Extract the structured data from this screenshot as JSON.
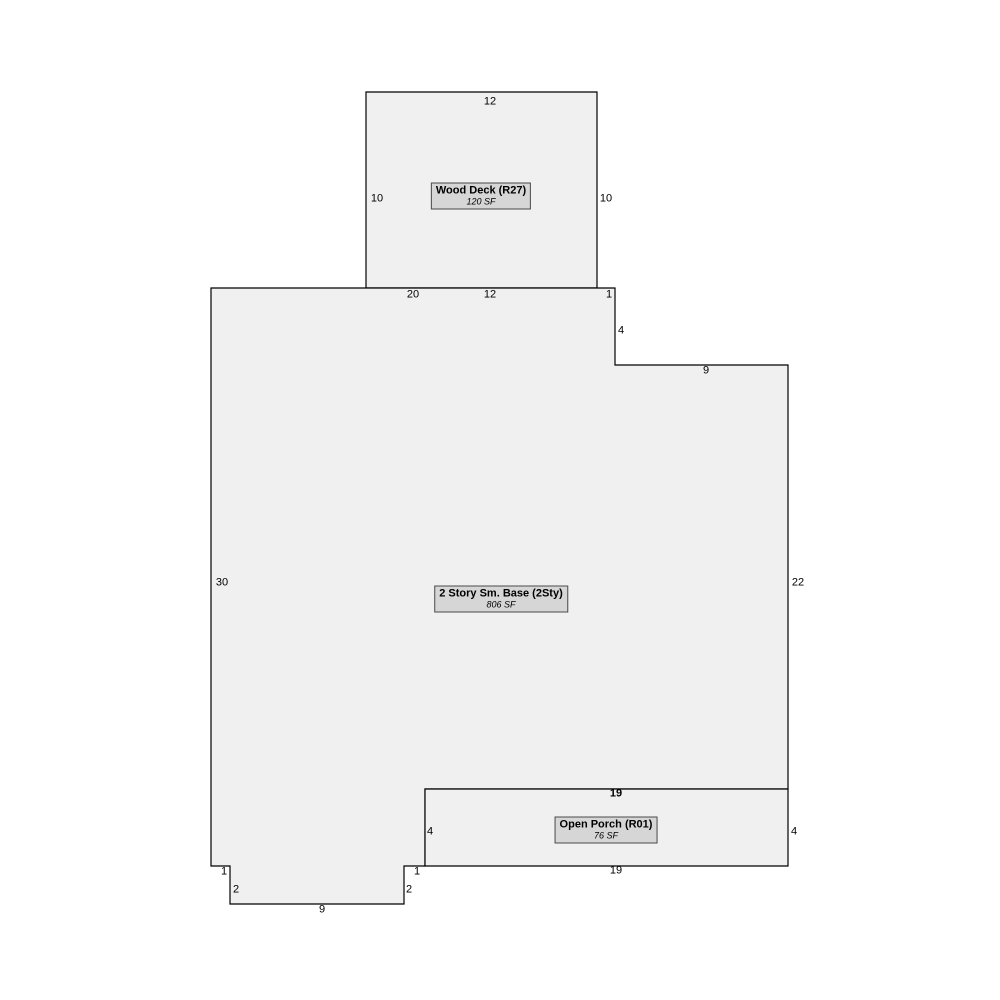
{
  "sketch": {
    "colors": {
      "background": "#ffffff",
      "shape_fill": "#f0f0f0",
      "outline": "#000000",
      "label_box_fill": "#d6d6d6",
      "label_box_border": "#4a4a4a",
      "text": "#000000"
    },
    "areas": [
      {
        "id": "wood-deck",
        "name": "Wood Deck (R27)",
        "area_sf": "120 SF",
        "polygon": [
          [
            366,
            92
          ],
          [
            597,
            92
          ],
          [
            597,
            288
          ],
          [
            366,
            288
          ]
        ],
        "label_center": [
          481,
          196
        ],
        "dimensions": [
          {
            "text": "12",
            "x": 490,
            "y": 102
          },
          {
            "text": "10",
            "x": 377,
            "y": 199
          },
          {
            "text": "10",
            "x": 606,
            "y": 199
          }
        ]
      },
      {
        "id": "two-story-base",
        "name": "2 Story Sm. Base (2Sty)",
        "area_sf": "806 SF",
        "polygon": [
          [
            211,
            288
          ],
          [
            615,
            288
          ],
          [
            615,
            365
          ],
          [
            788,
            365
          ],
          [
            788,
            789
          ],
          [
            425,
            789
          ],
          [
            425,
            866
          ],
          [
            404,
            866
          ],
          [
            404,
            904
          ],
          [
            230,
            904
          ],
          [
            230,
            866
          ],
          [
            211,
            866
          ]
        ],
        "label_center": [
          501,
          599
        ],
        "dimensions": [
          {
            "text": "20",
            "x": 413,
            "y": 295
          },
          {
            "text": "12",
            "x": 490,
            "y": 295
          },
          {
            "text": "1",
            "x": 609,
            "y": 295
          },
          {
            "text": "4",
            "x": 621,
            "y": 331
          },
          {
            "text": "9",
            "x": 706,
            "y": 371
          },
          {
            "text": "22",
            "x": 798,
            "y": 583
          },
          {
            "text": "30",
            "x": 222,
            "y": 583
          },
          {
            "text": "1",
            "x": 224,
            "y": 872
          },
          {
            "text": "2",
            "x": 236,
            "y": 890
          },
          {
            "text": "9",
            "x": 322,
            "y": 910
          },
          {
            "text": "2",
            "x": 409,
            "y": 890
          },
          {
            "text": "1",
            "x": 417,
            "y": 872
          }
        ]
      },
      {
        "id": "open-porch",
        "name": "Open Porch (R01)",
        "area_sf": "76 SF",
        "polygon": [
          [
            425,
            789
          ],
          [
            788,
            789
          ],
          [
            788,
            866
          ],
          [
            425,
            866
          ]
        ],
        "label_center": [
          606,
          830
        ],
        "dimensions": [
          {
            "text": "19",
            "x": 616,
            "y": 794,
            "bold": true
          },
          {
            "text": "4",
            "x": 430,
            "y": 832
          },
          {
            "text": "4",
            "x": 794,
            "y": 832
          },
          {
            "text": "19",
            "x": 616,
            "y": 871
          }
        ]
      }
    ]
  }
}
